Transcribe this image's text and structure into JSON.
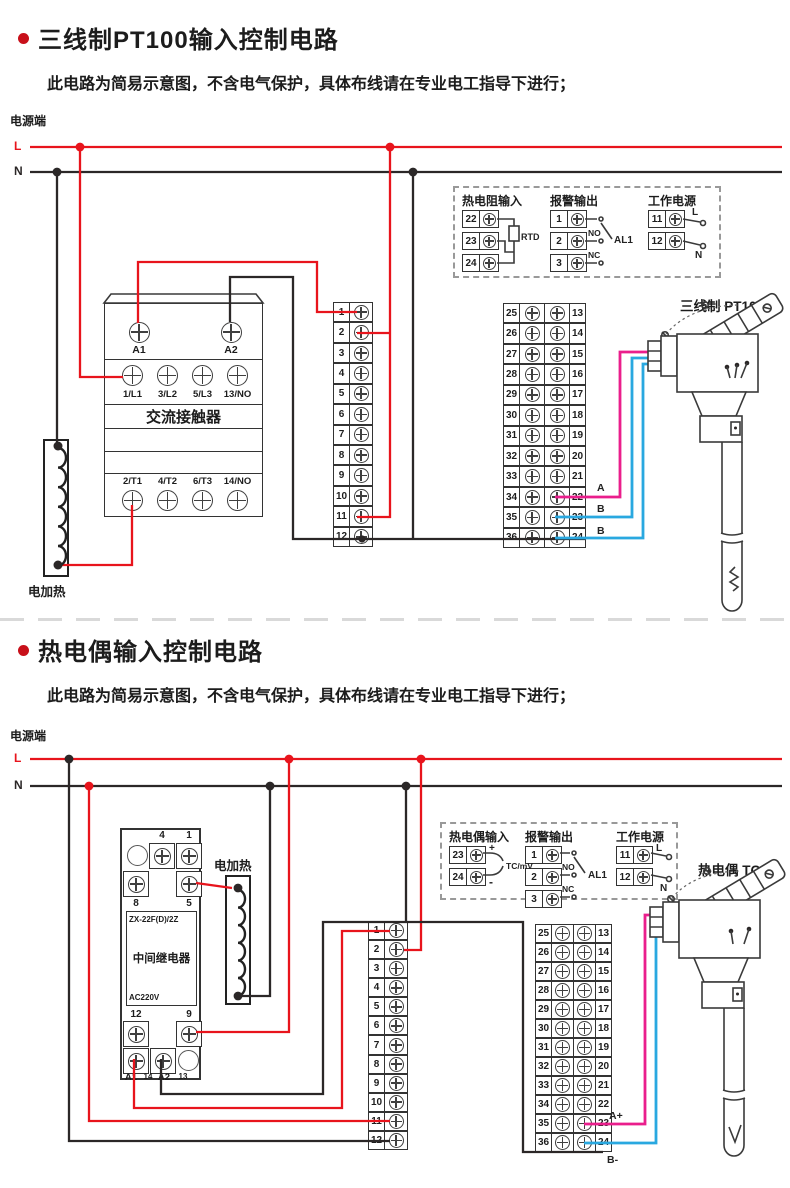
{
  "colors": {
    "accent_red": "#c8101a",
    "wire_red": "#e8141c",
    "wire_black": "#2b2727",
    "wire_pink": "#ea1e8c",
    "wire_blue": "#29a8e0"
  },
  "section1": {
    "title": "三线制PT100输入控制电路",
    "subtitle": "此电路为简易示意图，不含电气保护，具体布线请在专业电工指导下进行；",
    "power_label": "电源端",
    "l_label": "L",
    "n_label": "N",
    "contactor": {
      "a1": "A1",
      "a2": "A2",
      "row1": [
        "1/L1",
        "3/L2",
        "5/L3",
        "13/NO"
      ],
      "name": "交流接触器",
      "row2": [
        "2/T1",
        "4/T2",
        "6/T3",
        "14/NO"
      ]
    },
    "heater_label": "电加热",
    "mid_block": [
      "1",
      "2",
      "3",
      "4",
      "5",
      "6",
      "7",
      "8",
      "9",
      "10",
      "11",
      "12"
    ],
    "dual_block": [
      {
        "l": "25",
        "r": "13"
      },
      {
        "l": "26",
        "r": "14"
      },
      {
        "l": "27",
        "r": "15"
      },
      {
        "l": "28",
        "r": "16"
      },
      {
        "l": "29",
        "r": "17"
      },
      {
        "l": "30",
        "r": "18"
      },
      {
        "l": "31",
        "r": "19"
      },
      {
        "l": "32",
        "r": "20"
      },
      {
        "l": "33",
        "r": "21"
      },
      {
        "l": "34",
        "r": "22"
      },
      {
        "l": "35",
        "r": "23"
      },
      {
        "l": "36",
        "r": "24"
      }
    ],
    "io_box": {
      "rtd": {
        "title": "热电阻输入",
        "terminals": [
          "22",
          "23",
          "24"
        ],
        "tag": "RTD"
      },
      "alarm": {
        "title": "报警输出",
        "terminals": [
          "1",
          "2",
          "3"
        ],
        "no_label": "NO",
        "nc_label": "NC",
        "al_label": "AL1"
      },
      "power": {
        "title": "工作电源",
        "terminals": [
          "11",
          "12"
        ],
        "l_label": "L",
        "n_label": "N"
      }
    },
    "sensor_label": "三线制 PT100",
    "wire_labels": {
      "a": "A",
      "b1": "B",
      "b2": "B"
    }
  },
  "section2": {
    "title": "热电偶输入控制电路",
    "subtitle": "此电路为简易示意图，不含电气保护，具体布线请在专业电工指导下进行；",
    "power_label": "电源端",
    "l_label": "L",
    "n_label": "N",
    "relay": {
      "top_labels": [
        "4",
        "1"
      ],
      "mid_labels": [
        "8",
        "5"
      ],
      "model": "ZX-22F(D)/2Z",
      "name": "中间继电器",
      "voltage": "AC220V",
      "bot_labels": [
        "12",
        "9"
      ],
      "base_labels": [
        "A1",
        "14",
        "A2",
        "13"
      ]
    },
    "heater_label": "电加热",
    "mid_block": [
      "1",
      "2",
      "3",
      "4",
      "5",
      "6",
      "7",
      "8",
      "9",
      "10",
      "11",
      "12"
    ],
    "dual_block": [
      {
        "l": "25",
        "r": "13"
      },
      {
        "l": "26",
        "r": "14"
      },
      {
        "l": "27",
        "r": "15"
      },
      {
        "l": "28",
        "r": "16"
      },
      {
        "l": "29",
        "r": "17"
      },
      {
        "l": "30",
        "r": "18"
      },
      {
        "l": "31",
        "r": "19"
      },
      {
        "l": "32",
        "r": "20"
      },
      {
        "l": "33",
        "r": "21"
      },
      {
        "l": "34",
        "r": "22"
      },
      {
        "l": "35",
        "r": "23"
      },
      {
        "l": "36",
        "r": "24"
      }
    ],
    "io_box": {
      "tc": {
        "title": "热电偶输入",
        "terminals": [
          "23",
          "24"
        ],
        "plus": "+",
        "minus": "-",
        "tag": "TC/mV"
      },
      "alarm": {
        "title": "报警输出",
        "terminals": [
          "1",
          "2",
          "3"
        ],
        "no_label": "NO",
        "nc_label": "NC",
        "al_label": "AL1"
      },
      "power": {
        "title": "工作电源",
        "terminals": [
          "11",
          "12"
        ],
        "l_label": "L",
        "n_label": "N"
      }
    },
    "sensor_label": "热电偶 TC",
    "wire_labels": {
      "a": "A+",
      "b": "B-"
    }
  }
}
